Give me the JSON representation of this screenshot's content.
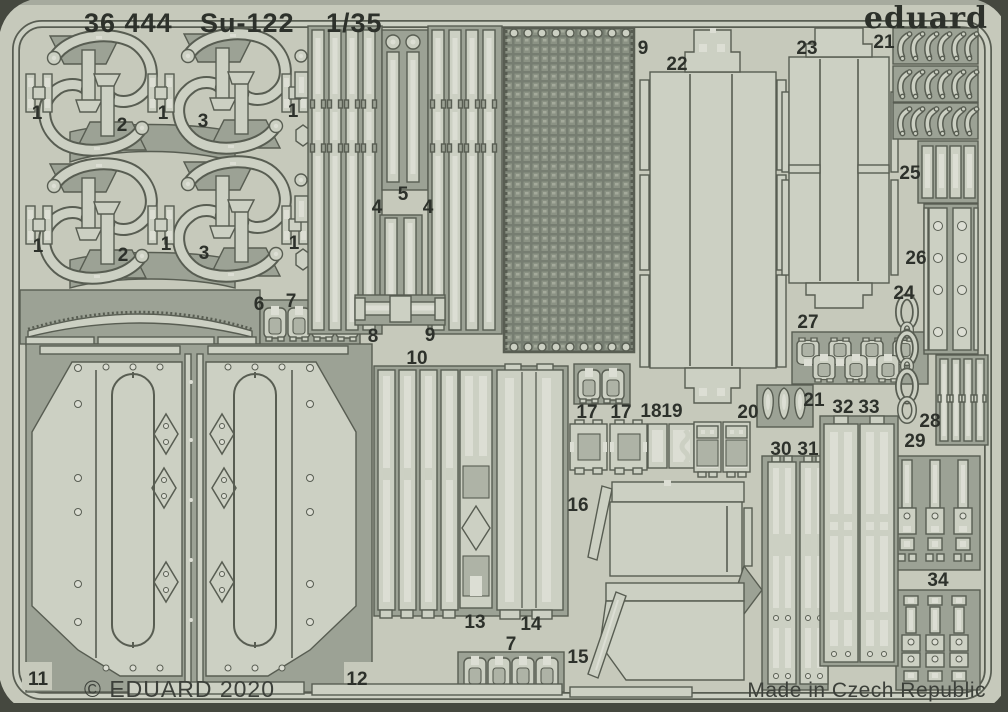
{
  "header": {
    "catalog": "36 444",
    "product": "Su-122",
    "scale": "1/35",
    "brand": "eduard"
  },
  "footer": {
    "copyright": "© EDUARD 2020",
    "origin": "Made in Czech Republic"
  },
  "colors": {
    "sheet": "#c6c9bb",
    "etched": "#9ca295",
    "part": "#ccd0c3",
    "slot": "#dcded4",
    "pmid": "#aeb3a6",
    "outline": "#585d52",
    "mesh": "#767d71",
    "edge": "#45483f",
    "text": "#2d312b",
    "textsoft": "#3c403a"
  },
  "part_labels": [
    {
      "n": "1",
      "x": 37,
      "y": 119
    },
    {
      "n": "2",
      "x": 122,
      "y": 131
    },
    {
      "n": "1",
      "x": 163,
      "y": 119
    },
    {
      "n": "3",
      "x": 203,
      "y": 127
    },
    {
      "n": "1",
      "x": 293,
      "y": 117
    },
    {
      "n": "1",
      "x": 38,
      "y": 252
    },
    {
      "n": "2",
      "x": 123,
      "y": 261
    },
    {
      "n": "1",
      "x": 166,
      "y": 250
    },
    {
      "n": "3",
      "x": 204,
      "y": 259
    },
    {
      "n": "1",
      "x": 294,
      "y": 249
    },
    {
      "n": "4",
      "x": 377,
      "y": 213
    },
    {
      "n": "5",
      "x": 403,
      "y": 200
    },
    {
      "n": "4",
      "x": 428,
      "y": 213
    },
    {
      "n": "6",
      "x": 259,
      "y": 310
    },
    {
      "n": "7",
      "x": 291,
      "y": 307
    },
    {
      "n": "8",
      "x": 373,
      "y": 342
    },
    {
      "n": "9",
      "x": 430,
      "y": 341
    },
    {
      "n": "9",
      "x": 643,
      "y": 54
    },
    {
      "n": "10",
      "x": 417,
      "y": 364
    },
    {
      "n": "11",
      "x": 38,
      "y": 685
    },
    {
      "n": "12",
      "x": 357,
      "y": 685
    },
    {
      "n": "13",
      "x": 475,
      "y": 628
    },
    {
      "n": "14",
      "x": 531,
      "y": 630
    },
    {
      "n": "7",
      "x": 511,
      "y": 650
    },
    {
      "n": "15",
      "x": 578,
      "y": 663
    },
    {
      "n": "16",
      "x": 578,
      "y": 511
    },
    {
      "n": "17",
      "x": 587,
      "y": 418
    },
    {
      "n": "17",
      "x": 621,
      "y": 418
    },
    {
      "n": "18",
      "x": 651,
      "y": 417
    },
    {
      "n": "19",
      "x": 672,
      "y": 417
    },
    {
      "n": "20",
      "x": 748,
      "y": 418
    },
    {
      "n": "22",
      "x": 677,
      "y": 70
    },
    {
      "n": "23",
      "x": 807,
      "y": 54
    },
    {
      "n": "21",
      "x": 884,
      "y": 48
    },
    {
      "n": "25",
      "x": 910,
      "y": 179
    },
    {
      "n": "26",
      "x": 916,
      "y": 264
    },
    {
      "n": "24",
      "x": 904,
      "y": 299
    },
    {
      "n": "27",
      "x": 808,
      "y": 328
    },
    {
      "n": "21",
      "x": 814,
      "y": 406
    },
    {
      "n": "32",
      "x": 843,
      "y": 413
    },
    {
      "n": "33",
      "x": 869,
      "y": 413
    },
    {
      "n": "28",
      "x": 930,
      "y": 427
    },
    {
      "n": "30",
      "x": 781,
      "y": 455
    },
    {
      "n": "31",
      "x": 808,
      "y": 455
    },
    {
      "n": "29",
      "x": 915,
      "y": 447
    },
    {
      "n": "34",
      "x": 938,
      "y": 586
    }
  ]
}
